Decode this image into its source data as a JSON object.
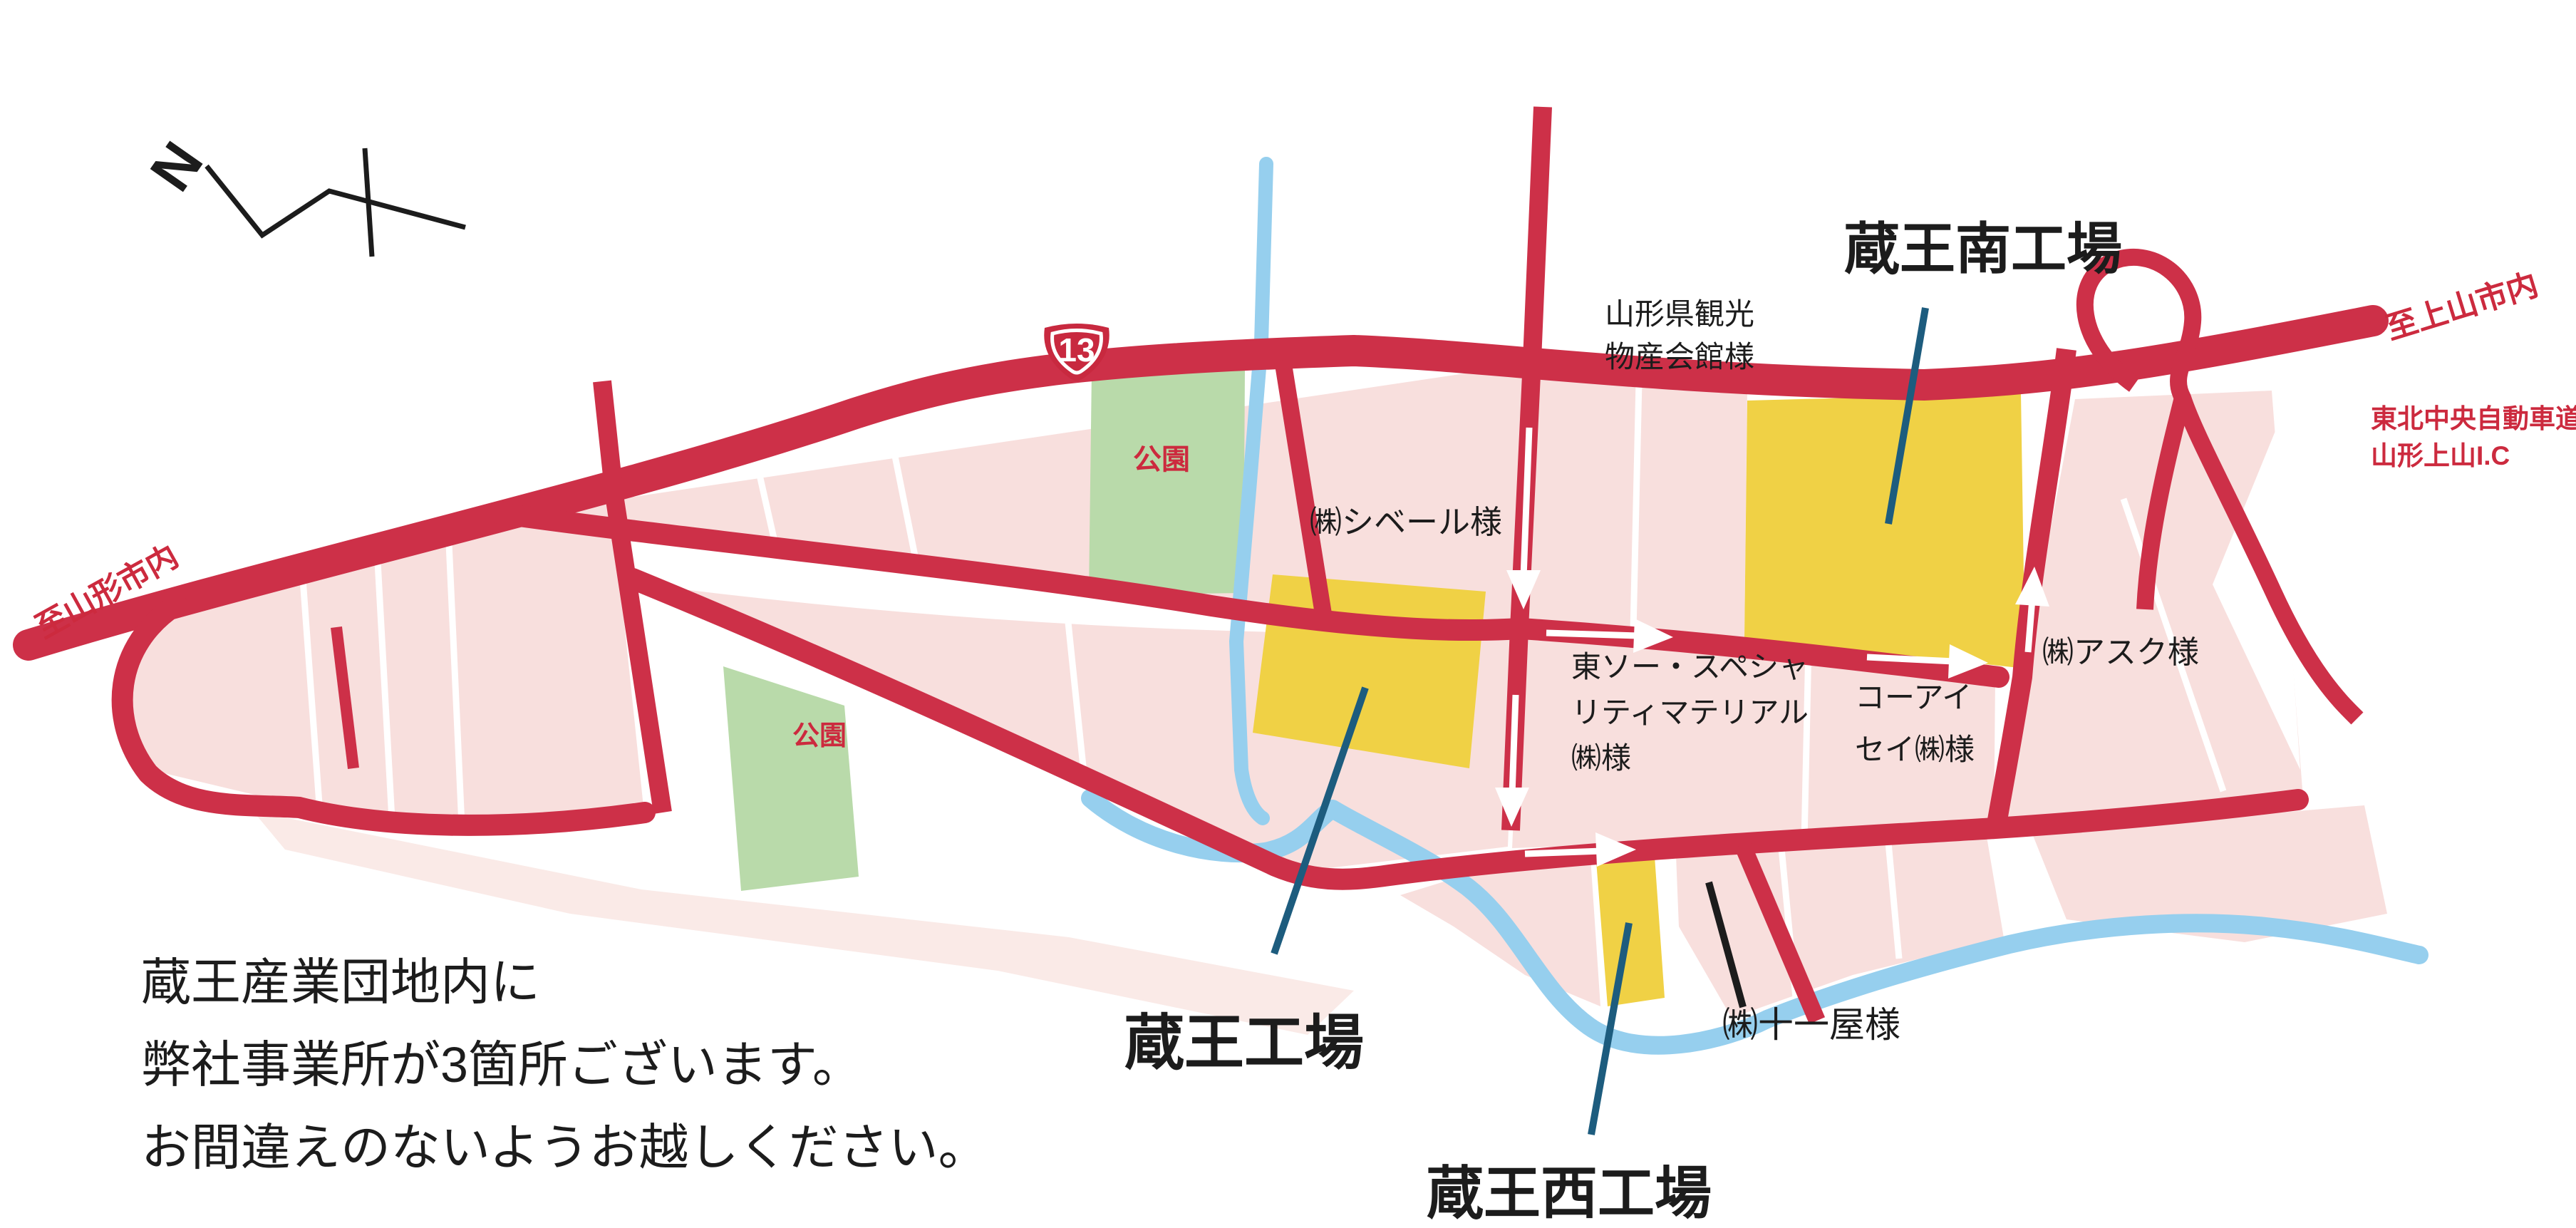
{
  "compass": {
    "north_label": "N"
  },
  "route_shield": {
    "number": "13"
  },
  "direction_labels": {
    "to_kaminoyama": "至上山市内",
    "to_yamagata_city": "至山形市内"
  },
  "expressway": {
    "line1": "東北中央自動車道",
    "line2": "山形上山I.C"
  },
  "factories": {
    "south": {
      "name": "蔵王南工場"
    },
    "main": {
      "name": "蔵王工場"
    },
    "west": {
      "name": "蔵王西工場"
    }
  },
  "landmarks": {
    "bussankaikan": {
      "line1": "山形県観光",
      "line2": "物産会館様"
    },
    "cybele": {
      "name": "㈱シベール様"
    },
    "tosoh": {
      "line1": "東ソー・スペシャ",
      "line2": "リティマテリアル",
      "line3": "㈱様"
    },
    "koa_isei": {
      "line1": "コーアイ",
      "line2": "セイ㈱様"
    },
    "ask": {
      "name": "㈱アスク様"
    },
    "juichiya": {
      "name": "㈱十一屋様"
    }
  },
  "parks": {
    "park_north": "公園",
    "park_west": "公園"
  },
  "note": {
    "line1": "蔵王産業団地内に",
    "line2": "弊社事業所が3箇所ございます。",
    "line3": "お間違えのないようお越しください。"
  },
  "colors": {
    "road_red": "#cd3048",
    "block_pink": "#f8dfdd",
    "block_pink_light": "#faeae7",
    "park_green": "#b9daaa",
    "river_blue": "#96cfee",
    "factory_yellow": "#f0d145",
    "leader_teal": "#1d5c7e",
    "red_text": "#cc2a3e",
    "black_text": "#1c1c1c"
  }
}
